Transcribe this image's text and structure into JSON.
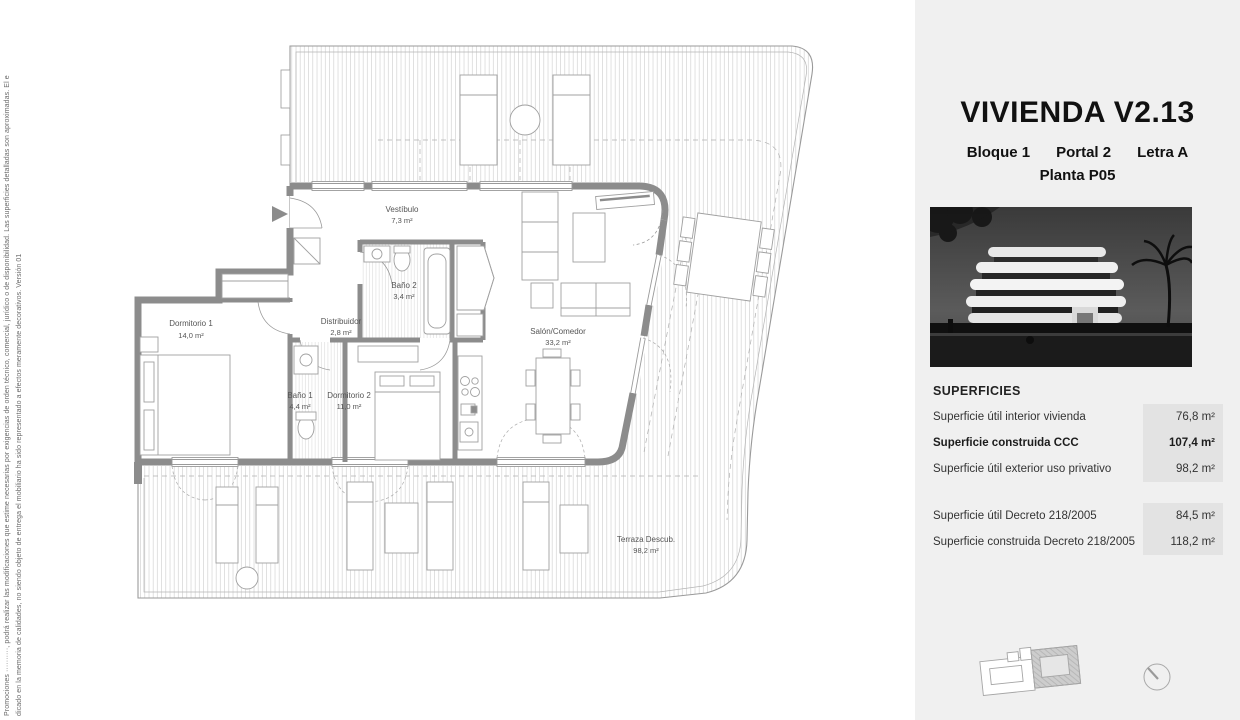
{
  "sidebar": {
    "line1": "Promociones ··········, podrá realizar las modificaciones que estime necesarias por exigencias de orden técnico, comercial, jurídico o de disponibilidad. Las superficies detalladas son aproximadas. El e",
    "line2": "dicado en la memoria de calidades, no siendo objeto de entrega el mobiliario ha sido representado a efectos meramente decorativos. Versión 01"
  },
  "plan": {
    "rooms": [
      {
        "name": "Vestíbulo",
        "area": "7,3 m²"
      },
      {
        "name": "Baño 2",
        "area": "3,4 m²"
      },
      {
        "name": "Dormitorio 1",
        "area": "14,0 m²"
      },
      {
        "name": "Distribuidor",
        "area": "2,8 m²"
      },
      {
        "name": "Baño 1",
        "area": "4,4 m²"
      },
      {
        "name": "Dormitorio 2",
        "area": "11,0 m²"
      },
      {
        "name": "Salón/Comedor",
        "area": "33,2 m²"
      },
      {
        "name": "Terraza Descub.",
        "area": "98,2 m²"
      }
    ]
  },
  "panel": {
    "title": "VIVIENDA V2.13",
    "bloque": "Bloque 1",
    "portal": "Portal 2",
    "letra": "Letra A",
    "planta": "Planta P05",
    "superficies": {
      "heading": "SUPERFICIES",
      "rows_main": [
        {
          "label": "Superficie útil interior vivienda",
          "value": "76,8 m²"
        },
        {
          "label": "Superficie construida CCC",
          "value": "107,4 m²"
        },
        {
          "label": "Superficie útil exterior uso privativo",
          "value": "98,2 m²"
        }
      ],
      "rows_decreto": [
        {
          "label": "Superficie útil Decreto 218/2005",
          "value": "84,5 m²"
        },
        {
          "label": "Superficie construida Decreto 218/2005",
          "value": "118,2 m²"
        }
      ]
    }
  },
  "colors": {
    "panel_bg": "#f0f0f0",
    "value_cell_bg": "#e3e3e3",
    "wall": "#8c8c8c",
    "thin_line": "#9a9a9a",
    "hatch": "#cccccc",
    "label_text": "#555555"
  }
}
